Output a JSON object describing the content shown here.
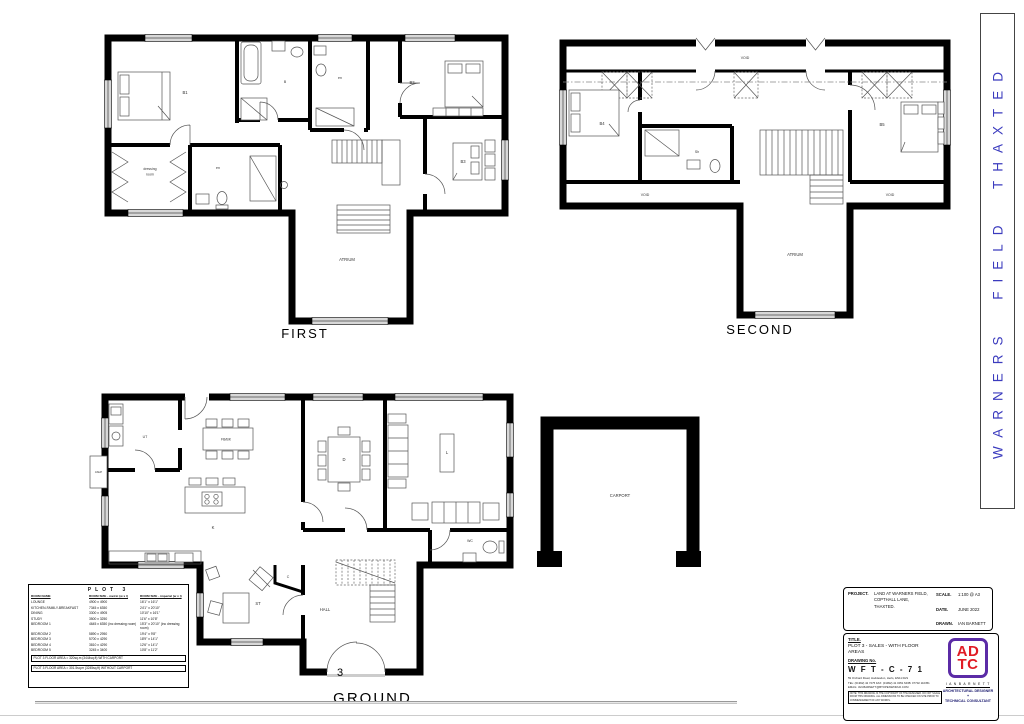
{
  "sheet": {
    "captions": {
      "first": "FIRST",
      "second": "SECOND",
      "ground": "GROUND",
      "plot_number": "3"
    }
  },
  "banner": {
    "text": "WARNERS FIELD THAXTED",
    "color": "#3b3bbe"
  },
  "plans": {
    "first": {
      "labels": {
        "b1": "B1",
        "dressing_1": "dressing",
        "dressing_2": "room",
        "en_left": "en",
        "bathroom": "B",
        "en_right": "en",
        "b2": "B2",
        "b3": "B3",
        "atrium": "ATRIUM"
      }
    },
    "second": {
      "labels": {
        "b4": "B4",
        "sh": "Sh",
        "b5": "B5",
        "void_top": "VOID",
        "void_left": "VOID",
        "void_right": "VOID",
        "atrium": "ATRIUM"
      }
    },
    "ground": {
      "labels": {
        "ut": "UT",
        "fbbk": "FB/BK",
        "k": "K",
        "d": "D",
        "l": "L",
        "wc": "WC",
        "st": "ST",
        "c": "C",
        "hall": "HALL",
        "ashp": "ASHP"
      }
    },
    "carport": {
      "label": "CARPORT"
    }
  },
  "schedule": {
    "title": "PLOT 3",
    "headers": [
      "ROOM NAME",
      "ROOM SIZE - metric (w x l)",
      "ROOM SIZE - imperial (w x l)"
    ],
    "rows": [
      {
        "name": "LOUNGE",
        "metric": "4900 x 4900",
        "imperial": "16'1\" x 16'1\""
      },
      {
        "name": "KITCHEN-FAMILY-BREAKFAST",
        "metric": "7345 x 6350",
        "imperial": "24'1\" x 20'10\""
      },
      {
        "name": "DINING",
        "metric": "3300 x 4905",
        "imperial": "10'10\" x 16'1\""
      },
      {
        "name": "STUDY",
        "metric": "3500 x 3250",
        "imperial": "11'6\" x 10'8\""
      },
      {
        "name": "BEDROOM 1",
        "metric": "4645 x 6350 (inc dressing room)",
        "imperial": "15'3\" x 20'10\" (inc dressing room)"
      },
      {
        "name": "BEDROOM 2",
        "metric": "5890 x 2950",
        "imperial": "19'4\" x 9'8\""
      },
      {
        "name": "BEDROOM 3",
        "metric": "5700 x 4290",
        "imperial": "18'9\" x 14'1\""
      },
      {
        "name": "BEDROOM 4",
        "metric": "3810 x 4290",
        "imperial": "12'6\" x 14'1\""
      },
      {
        "name": "BEDROOM 5",
        "metric": "3245 x 3400",
        "imperial": "10'8\" x 11'2\""
      }
    ],
    "footnotes": [
      "PLOT 3 FLOOR AREA = 320sq.m (3444sq.ft) WITH CARPORT",
      "PLOT 3 FLOOR AREA = 301.5sq.m (3245sq.ft) WITHOUT CARPORT"
    ]
  },
  "titleblock": {
    "project_label": "PROJECT.",
    "project_lines": [
      "LAND AT WARNERS FIELD,",
      "COPTHALL LANE,",
      "THAXTED."
    ],
    "scale_label": "SCALE.",
    "scale_value": "1:100 @ A3",
    "date_label": "DATE.",
    "date_value": "JUNE 2022",
    "drawn_label": "DRAWN.",
    "drawn_value": "IAN BARNETT",
    "title_label": "TITLE.",
    "title_lines": [
      "PLOT 3 - SALES - WITH FLOOR",
      "AREAS"
    ],
    "drawing_no_label": "DRAWING No.",
    "drawing_no": "W F T - C - 7 1",
    "address": "59 Orchard Road, Hoddesdon, Herts, EN11 0HS",
    "phone": "TEL: (01992) 42 7275   FAX: (01992) 41 0051   MOB: 07702 110351",
    "email": "EMAIL: IAN.BARNETT@BTOPENWORLD.COM",
    "note": "NOTE: THIS DRAWING IS THE COPYRIGHT OF THE DESIGNER. DO NOT SCALE FROM THIS DRAWING. ALL DIMENSIONS TO BE CHECKED ON SITE PRIOR TO COMMENCEMENT OF ANY WORKS.",
    "logo": {
      "top": "AD",
      "bottom": "TC",
      "red": "#e01b24",
      "purple": "#5b2ba6",
      "name": "I A N   B A R N E T T",
      "tagline_1": "ARCHITECTURAL DESIGNER +",
      "tagline_2": "TECHNICAL CONSULTANT"
    }
  }
}
